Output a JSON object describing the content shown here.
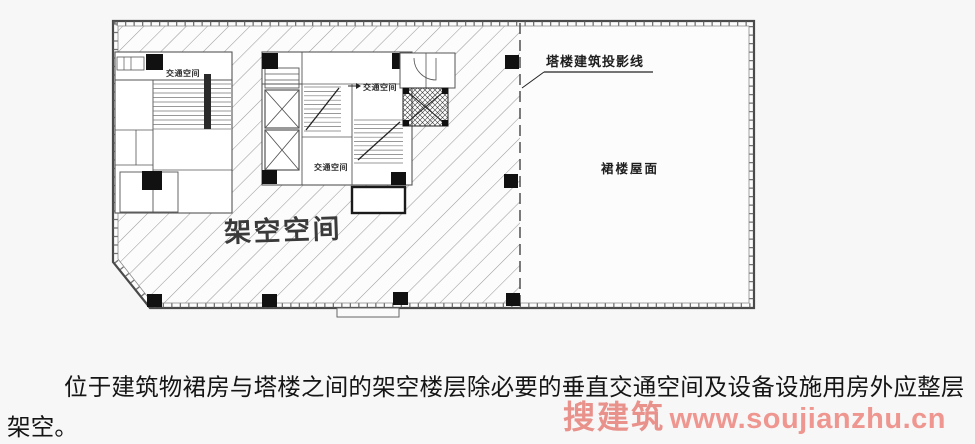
{
  "page": {
    "background": "#f7f7f7"
  },
  "plan": {
    "area_labels": {
      "stilt_space": "架空空间",
      "podium_roof": "裙楼屋面",
      "projection_line": "塔楼建筑投影线"
    },
    "room_labels": {
      "traffic_space_left": "交通空间",
      "traffic_space_mid_upper": "交通空间",
      "traffic_space_mid_lower": "交通空间"
    },
    "colors": {
      "hatch": "#9b9b9b",
      "wall": "#555555",
      "outline": "#4a4a4a",
      "column": "#111111"
    }
  },
  "caption": {
    "line1": "位于建筑物裙房与塔楼之间的架空楼层除必要的垂直交通空间及设备设施用房外应整层",
    "line2": "架空。"
  },
  "watermark": {
    "brand": "搜建筑",
    "url": "www.soujianzhu.cn",
    "color": "#ea8c86"
  }
}
